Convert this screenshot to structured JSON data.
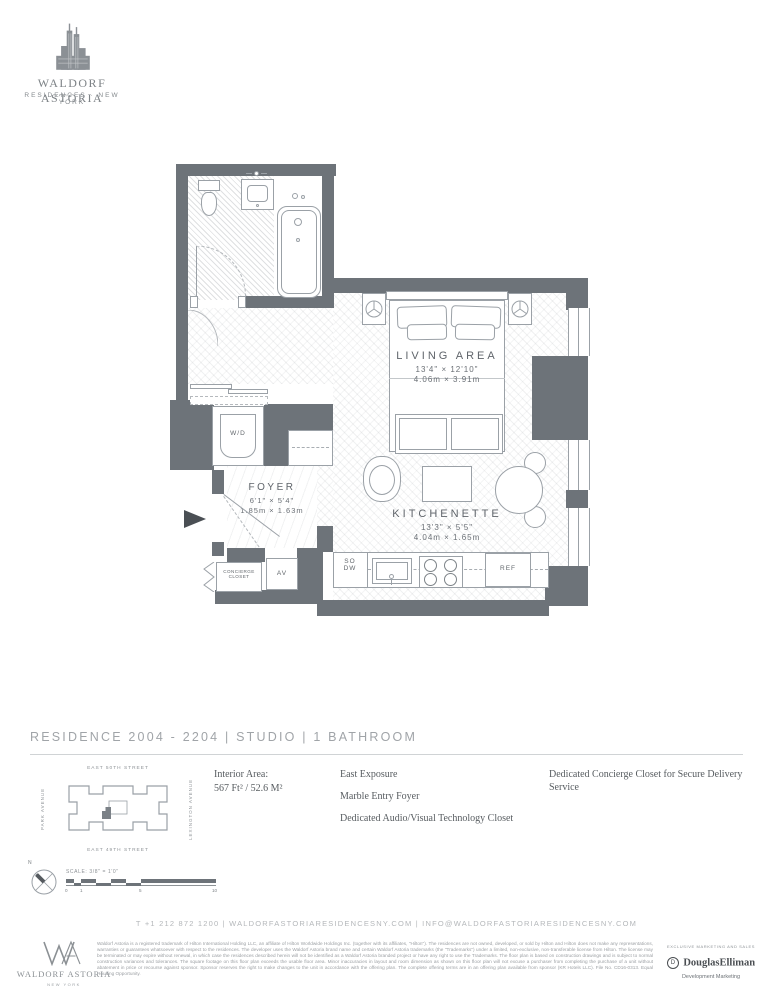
{
  "brand": {
    "building_icon": "waldorf-astoria-towers",
    "name": "WALDORF ASTORIA",
    "subtitle": "RESIDENCES · NEW YORK"
  },
  "floorplan": {
    "living": {
      "name": "LIVING AREA",
      "imperial": "13'4\" × 12'10\"",
      "metric": "4.06m × 3.91m"
    },
    "kitchenette": {
      "name": "KITCHENETTE",
      "imperial": "13'3\" × 5'5\"",
      "metric": "4.04m × 1.65m"
    },
    "foyer": {
      "name": "FOYER",
      "imperial": "6'1\" × 5'4\"",
      "metric": "1.85m × 1.63m"
    },
    "labels": {
      "washer_dryer": "W/D",
      "av_closet": "AV",
      "concierge_line1": "CONCIERGE",
      "concierge_line2": "CLOSET",
      "so": "SO",
      "dw": "DW",
      "refrigerator": "REF"
    }
  },
  "residence_bar": {
    "title": "RESIDENCE 2004 - 2204 | STUDIO | 1 BATHROOM"
  },
  "keyplan": {
    "street_top": "EAST 50TH STREET",
    "street_bottom": "EAST 49TH STREET",
    "avenue_left": "PARK AVENUE",
    "avenue_right": "LEXINGTON AVENUE"
  },
  "details": {
    "interior_area_label": "Interior Area:",
    "interior_area_value": "567 Ft² / 52.6 M²",
    "features_left": [
      "East Exposure",
      "Marble Entry Foyer",
      "Dedicated Audio/Visual Technology Closet"
    ],
    "features_right": [
      "Dedicated Concierge Closet for Secure Delivery Service"
    ]
  },
  "scale": {
    "north": "N",
    "label": "SCALE: 3/8\" = 1'0\"",
    "ticks": [
      "0",
      "1",
      "5",
      "10"
    ]
  },
  "contact": {
    "line": "T +1 212 872 1200  |  WALDORFASTORIARESIDENCESNY.COM  |  INFO@WALDORFASTORIARESIDENCESNY.COM"
  },
  "footer": {
    "wa_name": "WALDORF ASTORIA",
    "wa_sub": "NEW YORK",
    "disclaimer": "Waldorf Astoria is a registered trademark of Hilton International Holding LLC, an affiliate of Hilton Worldwide Holdings Inc. (together with its affiliates, \"Hilton\"). The residences are not owned, developed, or sold by Hilton and Hilton does not make any representations, warranties or guarantees whatsoever with respect to the residences. The developer uses the Waldorf Astoria brand name and certain Waldorf Astoria trademarks (the \"Trademarks\") under a limited, non-exclusive, non-transferable license from Hilton. The license may be terminated or may expire without renewal, in which case the residences described herein will not be identified as a Waldorf Astoria branded project or have any right to use the Trademarks. The floor plan is based on construction drawings and is subject to normal construction variances and tolerances. The square footage on this floor plan exceeds the usable floor area. Minor inaccuracies in layout and room dimension as shown on this floor plan will not excuse a purchaser from completing the purchase of a unit without abatement in price or recourse against sponsor. Sponsor reserves the right to make changes to the unit in accordance with the offering plan. The complete offering terms are in an offering plan available from sponsor (KR Hotels LLC). File No. CD16-0313. Equal Housing Opportunity.",
    "de_header": "EXCLUSIVE MARKETING AND SALES",
    "de_d": "D",
    "de_name": "DouglasElliman",
    "de_sub": "Development Marketing"
  }
}
